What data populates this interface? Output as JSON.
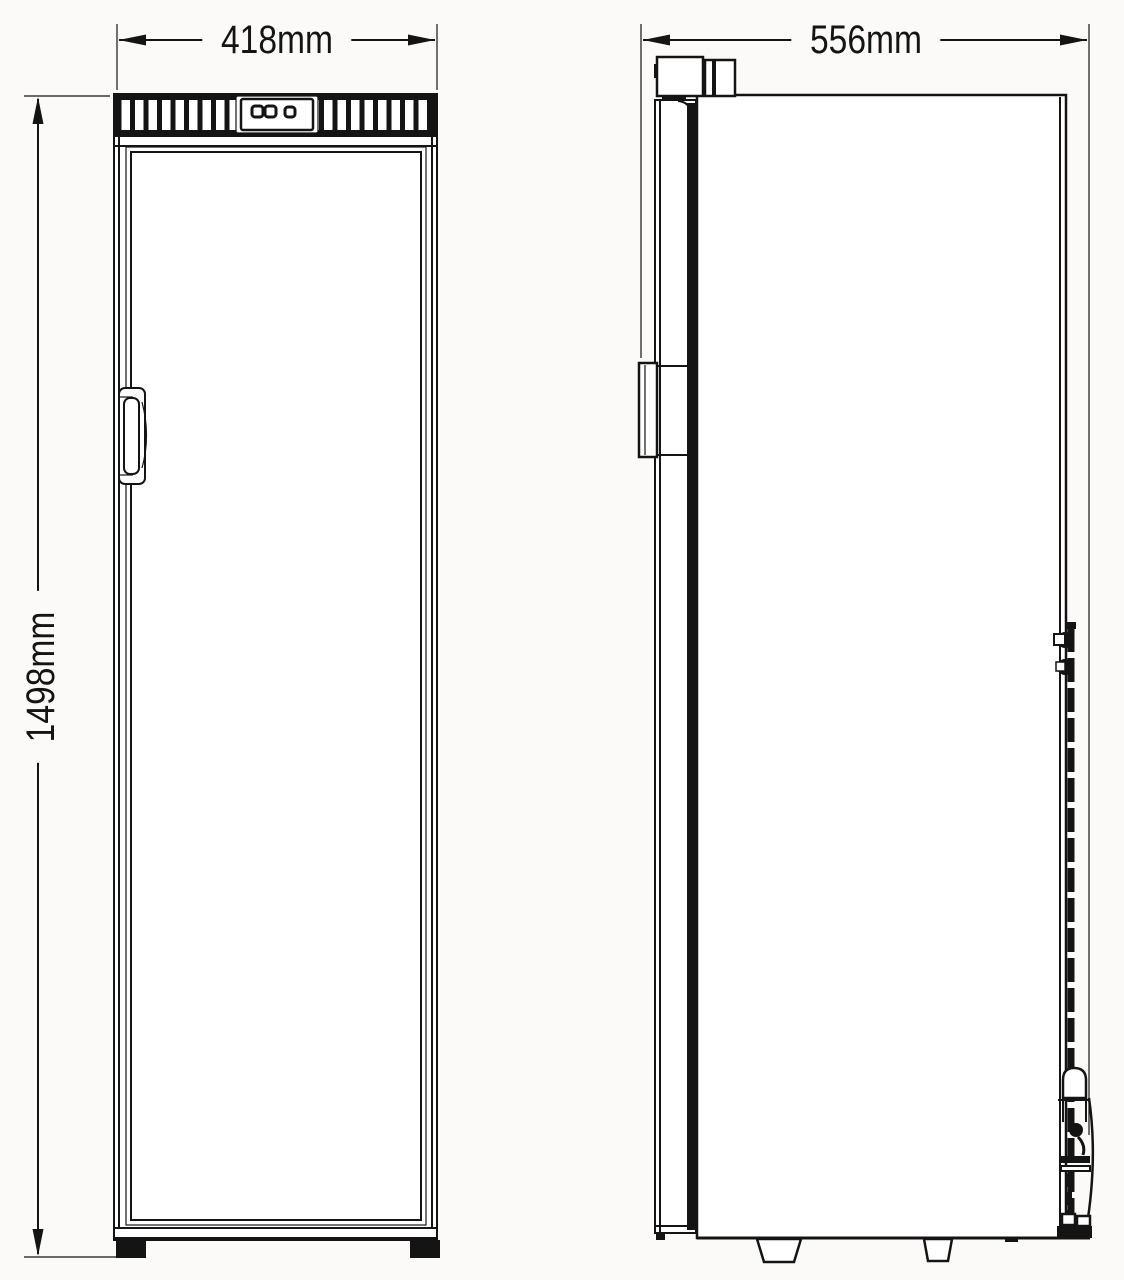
{
  "diagram": {
    "background": "#fbfaf8",
    "line_color": "#141414",
    "views": {
      "front": {
        "width_dimension": "418mm",
        "height_dimension": "1498mm"
      },
      "side": {
        "depth_dimension": "556mm"
      }
    }
  }
}
